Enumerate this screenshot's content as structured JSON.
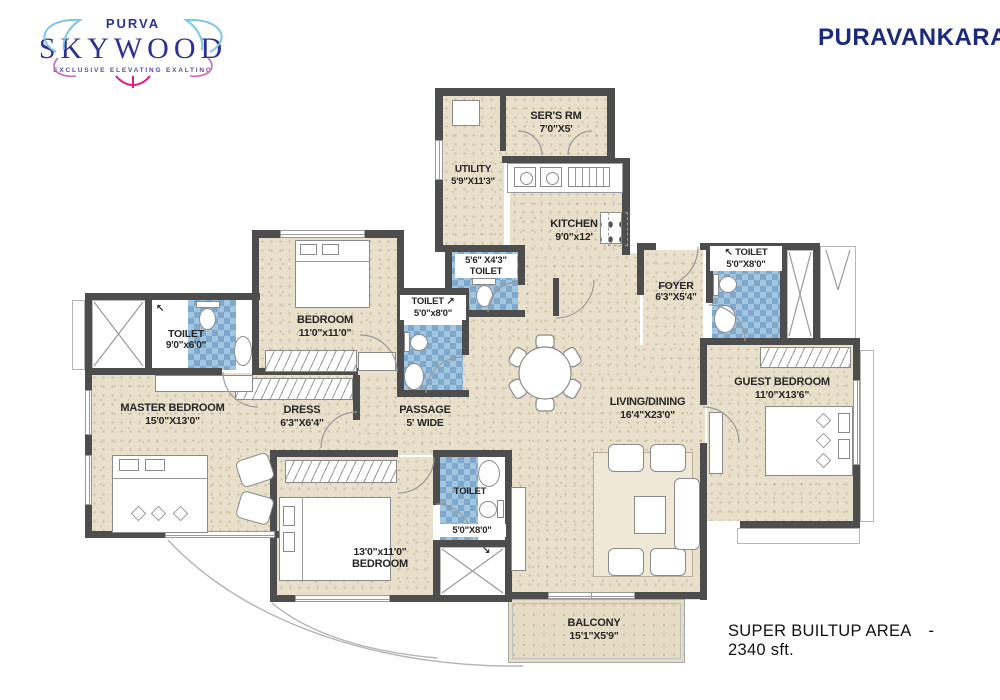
{
  "brand": {
    "purva": "PURVA",
    "skywood": "SKYWOOD",
    "tagline": "EXCLUSIVE ELEVATING EXALTING",
    "company": "PURAVANKARA"
  },
  "area": {
    "label": "SUPER BUILTUP AREA",
    "separator": "-",
    "value": "2340 sft."
  },
  "rooms": {
    "sers": {
      "name": "SER'S RM",
      "dims": "7'0\"X5'"
    },
    "utility": {
      "name": "UTILITY",
      "dims": "5'9\"X11'3\""
    },
    "kitchen": {
      "name": "KITCHEN",
      "dims": "9'0\"x12'"
    },
    "toilet_kitchen": {
      "name": "TOILET",
      "dims": "5'6\" X4'3\""
    },
    "toilet_passage": {
      "name": "TOILET",
      "dims": "5'0\"x8'0\""
    },
    "foyer": {
      "name": "FOYER",
      "dims": "6'3\"X5'4\""
    },
    "toilet_guest": {
      "name": "TOILET",
      "dims": "5'0\"X8'0\""
    },
    "bedroom2": {
      "name": "BEDROOM",
      "dims": "11'0\"x11'0\""
    },
    "toilet_master": {
      "name": "TOILET",
      "dims": "9'0\"x6'0\""
    },
    "master": {
      "name": "MASTER BEDROOM",
      "dims": "15'0\"X13'0\""
    },
    "dress": {
      "name": "DRESS",
      "dims": "6'3\"X6'4\""
    },
    "passage": {
      "name": "PASSAGE",
      "dims": "5' WIDE"
    },
    "living": {
      "name": "LIVING/DINING",
      "dims": "16'4\"X23'0\""
    },
    "guest": {
      "name": "GUEST BEDROOM",
      "dims": "11'0\"X13'6\""
    },
    "bedroom3": {
      "name": "BEDROOM",
      "dims": "13'0\"x11'0\""
    },
    "toilet_bedroom3": {
      "name": "TOILET",
      "dims": "5'0\"X8'0\""
    },
    "balcony": {
      "name": "BALCONY",
      "dims": "15'1\"X5'9\""
    }
  },
  "arrows": {
    "nw": "↖",
    "ne": "↗",
    "se": "↘"
  },
  "colors": {
    "wall": "#4d4d4d",
    "floor": "#e9e0cc",
    "tile": "#a3c6e0",
    "brand_navy": "#2e3192",
    "company_navy": "#1b2b7a"
  }
}
